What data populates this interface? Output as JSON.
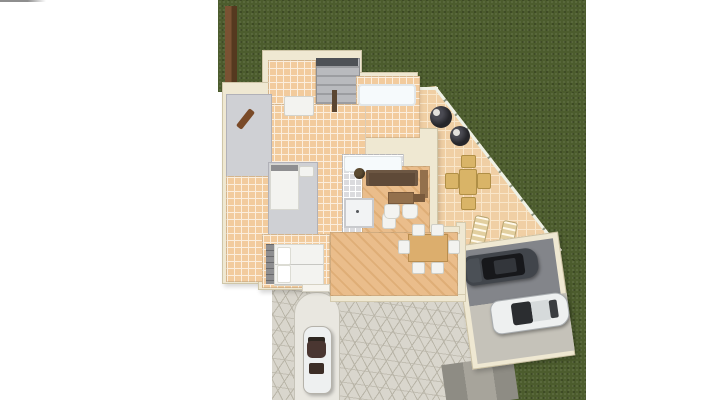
{
  "scene": {
    "type": "3d-floor-plan-render",
    "description": "Top-down 3D architectural rendering of a single-storey house with dark green lawn, tiled terrace with outdoor furniture, cobblestone driveway, a white convertible parked on the entry path, and a tilted carport containing a dark SUV and a white coupe",
    "colors": {
      "lawn": "#4c5c2d",
      "wall": "#efe8d2",
      "tile": "#f2cb9d",
      "tile-grout": "#fbeedd",
      "wood": "#eabd8b",
      "wood-dark": "#dfae77",
      "carpet": "#cfd0d4",
      "bath-tile": "#dbdbde",
      "stairs": "#b9babe",
      "stair-line": "#9c9da1",
      "terrace-tile": "#f0cfa4",
      "terrace-grout": "#f9e6c9",
      "cobble": "#d9d6cd",
      "cobble-line": "#b9b5a8",
      "path": "#e9e7e0",
      "fence-wood": "#6e492c",
      "sofa": "#5f4a38",
      "furniture-wood": "#93704c",
      "dining-table": "#dcae6d",
      "outdoor-set": "#d9b467",
      "lounge-dark": "#26262a",
      "sun-lounger": "#e2cf9f",
      "car-dark": "#41454b",
      "car-white": "#eef0f0",
      "convertible-top": "#4a3631",
      "road": "#8e8c84",
      "carport-floor": "#83858a",
      "carport-apron": "#c5c2b9",
      "bed-white": "#f3f3f0",
      "headboard": "#8e8e90",
      "decor-wood": "#7a4a28"
    },
    "areas": {
      "lawn": "garden lawn",
      "terrace": "tiled terrace",
      "driveway": "cobblestone driveway",
      "carport": "carport with two cars",
      "rooms": [
        "bedroom-top",
        "staircase",
        "bathroom-top",
        "hallway",
        "study",
        "bedroom-mid",
        "bathroom-mid",
        "living-room",
        "dining-room",
        "bedroom-bottom"
      ]
    },
    "vehicles": [
      "white-convertible",
      "dark-suv",
      "white-coupe"
    ],
    "furniture": [
      "sofa",
      "tv-cabinet",
      "coffee-table",
      "side-table",
      "planter",
      "armchairs",
      "dining-table-with-chairs",
      "beds",
      "bathtubs",
      "shower",
      "toilet",
      "patio-table-set",
      "round-lounge-chairs",
      "sun-loungers",
      "wardrobe"
    ]
  }
}
